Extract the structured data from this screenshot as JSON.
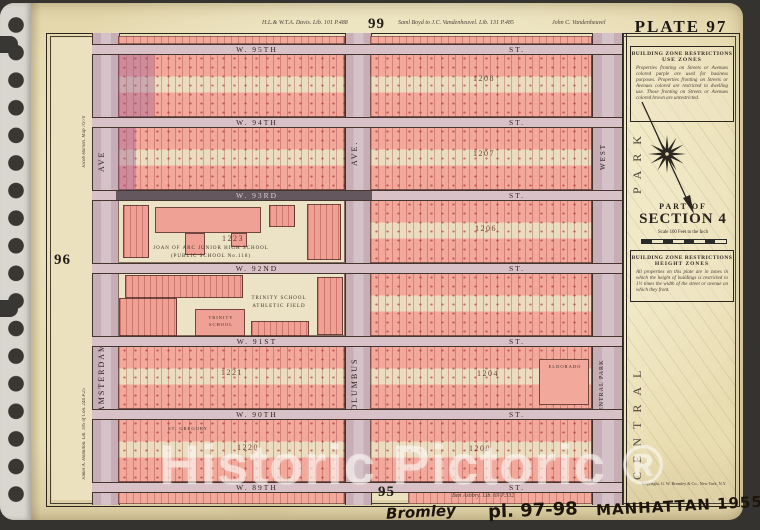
{
  "page_numbers": {
    "top": "99",
    "left": "96",
    "bottom": "95"
  },
  "plate_title": "PLATE 97",
  "margin_notes": {
    "top_left_deed": "H.L.& W.T.A. Davis. Lib. 101 P.488",
    "top_center_deed": "Saml Boyd to J.C. Vandenheuvel. Lib. 131 P.485",
    "top_right_deed": "John C. Vandenheuvel",
    "left_upper_deed": "Jacob Harsen. Map 76/70",
    "left_lower_deed": "James A. Hamilton. Lib. 185 of Con. 244 P.25",
    "bottom_deed": "Ben Ashbry. Lib. 69 P.332",
    "copyright": "Copyright, G. W. Bromley & Co., New York, N.Y."
  },
  "panel": {
    "use_zones_title1": "BUILDING ZONE RESTRICTIONS",
    "use_zones_title2": "USE ZONES",
    "use_zones_body": "Properties fronting on Streets or Avenues colored purple are used for business purposes. Properties fronting on Streets or Avenues colored are restricted to dwelling use. Those fronting on Streets or Avenues colored brown are unrestricted.",
    "part_of": "PART OF",
    "section": "SECTION 4",
    "scale_note": "Scale 100 Feet to the Inch",
    "height_zones_title1": "BUILDING ZONE RESTRICTIONS",
    "height_zones_title2": "HEIGHT ZONES",
    "height_zones_body": "All properties on this plate are in zones in which the height of buildings is restricted to 1½ times the width of the street or avenue on which they front."
  },
  "park_labels": {
    "central": "CENTRAL",
    "park": "PARK"
  },
  "avenues": {
    "amsterdam_short": "AVE",
    "amsterdam": "AMSTERDAM",
    "columbus_short": "AVE.",
    "columbus": "COLUMBUS",
    "cpw_short": "WEST",
    "cpw": "CENTRAL PARK"
  },
  "streets": [
    {
      "name": "W. 95TH",
      "suffix": "ST."
    },
    {
      "name": "W. 94TH",
      "suffix": "ST."
    },
    {
      "name": "W. 93RD",
      "suffix": "ST."
    },
    {
      "name": "W. 92ND",
      "suffix": "ST."
    },
    {
      "name": "W. 91ST",
      "suffix": "ST."
    },
    {
      "name": "W. 90TH",
      "suffix": "ST."
    },
    {
      "name": "W. 89TH",
      "suffix": "ST."
    }
  ],
  "block_numbers": {
    "r1e": "1208",
    "r2e": "1207",
    "r3e": "1206",
    "r3w": "1223",
    "r5w": "1221",
    "r5e": "1204",
    "r6w": "1220",
    "r6e": "1200"
  },
  "landmarks": {
    "joan_l1": "JOAN OF ARC JUNIOR HIGH SCHOOL",
    "joan_l2": "(PUBLIC SCHOOL No.118)",
    "trinity_field_l1": "TRINITY SCHOOL",
    "trinity_field_l2": "ATHLETIC FIELD",
    "trinity_l1": "TRINITY",
    "trinity_l2": "SCHOOL",
    "st_gregory": "ST. GREGORY",
    "eldorado": "ELDORADO"
  },
  "watermark": "Historic Pictoric ®",
  "handwriting": {
    "word1": "Bromley",
    "word2": "pl. 97-98",
    "word3": "MANHATTAN 1955"
  },
  "colors": {
    "paper": "#e9ddb2",
    "block_pink": "#f2a89b",
    "avenue_mauve": "#c7adb6",
    "street_band": "#d8c2c8",
    "commercial_purple": "#9b5f96",
    "building_red": "#9e201a",
    "map_ground": "#ece1bf",
    "backdrop": "#34332f"
  }
}
